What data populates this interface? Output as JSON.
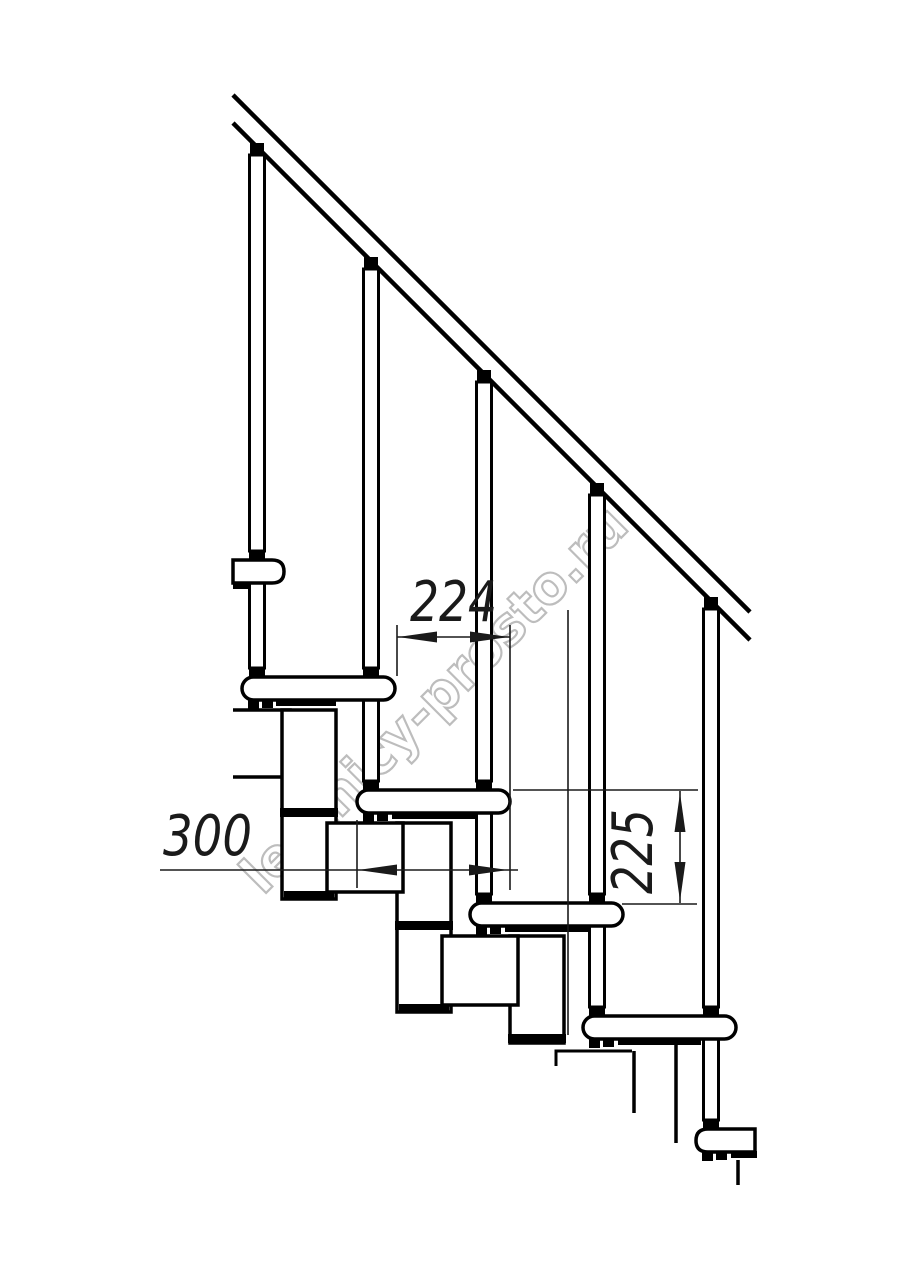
{
  "watermark": {
    "text": "lestnicy-prosto.ru",
    "color": "#bdbdbd"
  },
  "dimensions": {
    "step_run": {
      "label": "224"
    },
    "tread_length": {
      "label": "300"
    },
    "step_rise": {
      "label": "225"
    }
  },
  "drawing": {
    "background": "#ffffff",
    "line_color": "#000000",
    "visible_treads": 6,
    "visible_balusters": 5
  }
}
